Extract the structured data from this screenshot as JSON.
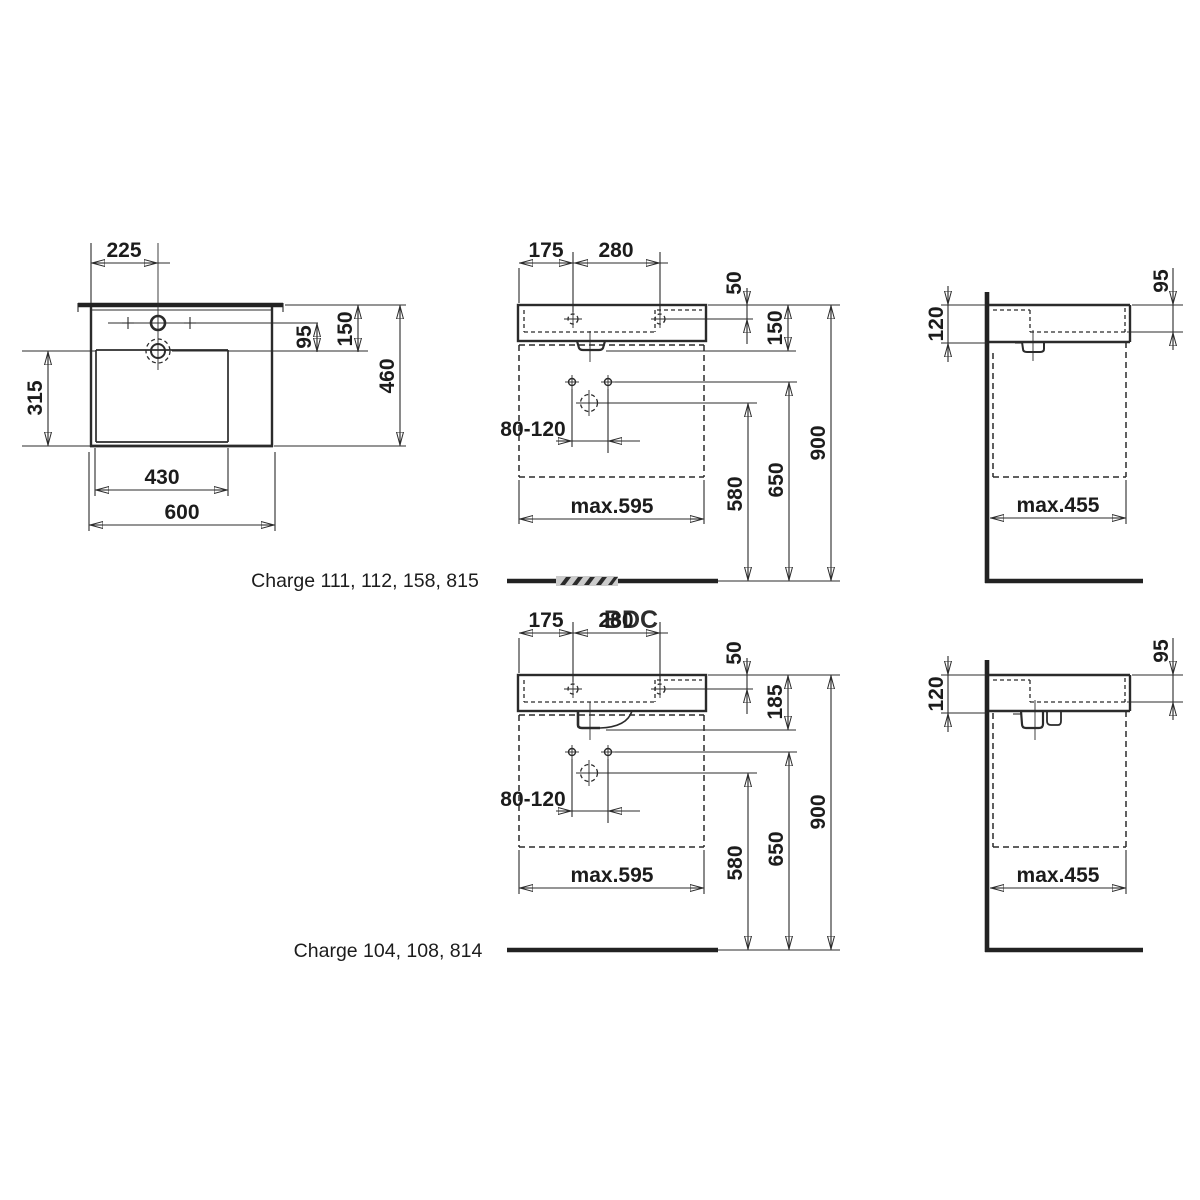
{
  "drawing": {
    "plan": {
      "label": "Charge 111, 112, 158, 815",
      "tap_offset": "225",
      "overflow_offset": "95",
      "ledge_depth": "150",
      "depth": "460",
      "bowl_depth": "315",
      "bowl_width": "430",
      "width": "600"
    },
    "front_top": {
      "tap_left": "175",
      "tap_span": "280",
      "tap_inset": "50",
      "height": "150",
      "fixing_span": "80-120",
      "unit_width": "max.595",
      "drain_height": "580",
      "fixing_height": "650",
      "rim_height": "900"
    },
    "side_top": {
      "edge_thickness": "120",
      "inner_depth": "95",
      "unit_depth": "max.455"
    },
    "front_bottom": {
      "label": "Charge 104, 108, 814",
      "tap_left": "175",
      "tap_span": "280",
      "tap_inset": "50",
      "height": "185",
      "fixing_span": "80-120",
      "unit_width": "max.595",
      "drain_height": "580",
      "fixing_height": "650",
      "rim_height": "900"
    },
    "side_bottom": {
      "edge_thickness": "120",
      "inner_depth": "95",
      "unit_depth": "max.455"
    },
    "watermark": {
      "text": "BDC",
      "color": "#8ec41d"
    }
  }
}
